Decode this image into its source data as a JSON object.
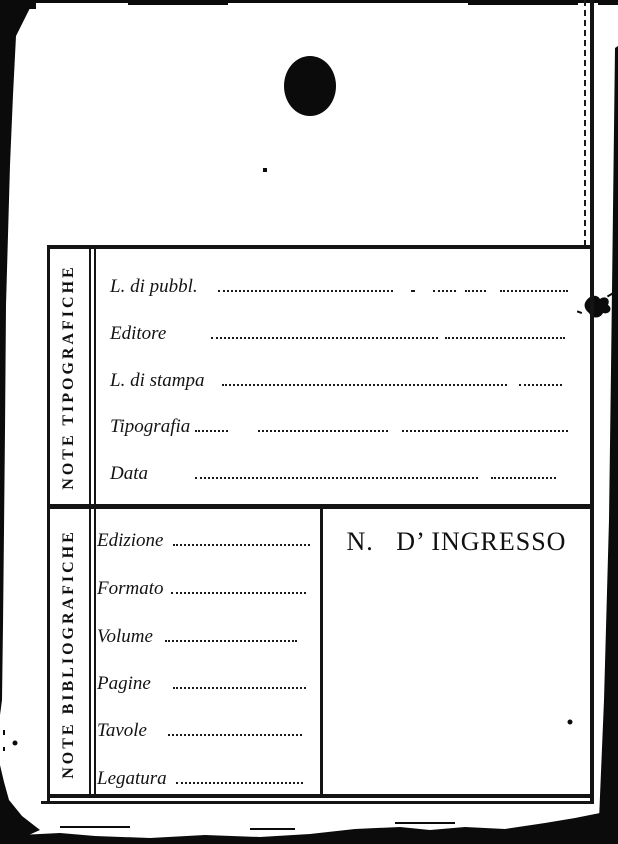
{
  "colors": {
    "paper": "#ffffff",
    "ink": "#111111"
  },
  "card": {
    "typographic_section": {
      "side_label": "NOTE TIPOGRAFICHE",
      "rows": [
        {
          "label": "L. di pubbl."
        },
        {
          "label": "Editore"
        },
        {
          "label": "L. di stampa"
        },
        {
          "label": "Tipografia"
        },
        {
          "label": "Data"
        }
      ]
    },
    "bibliographic_section": {
      "side_label": "NOTE BIBLIOGRAFICHE",
      "rows": [
        {
          "label": "Edizione"
        },
        {
          "label": "Formato"
        },
        {
          "label": "Volume"
        },
        {
          "label": "Pagine"
        },
        {
          "label": "Tavole"
        },
        {
          "label": "Legatura"
        }
      ],
      "accession_heading": "N.   D’ INGRESSO"
    }
  }
}
